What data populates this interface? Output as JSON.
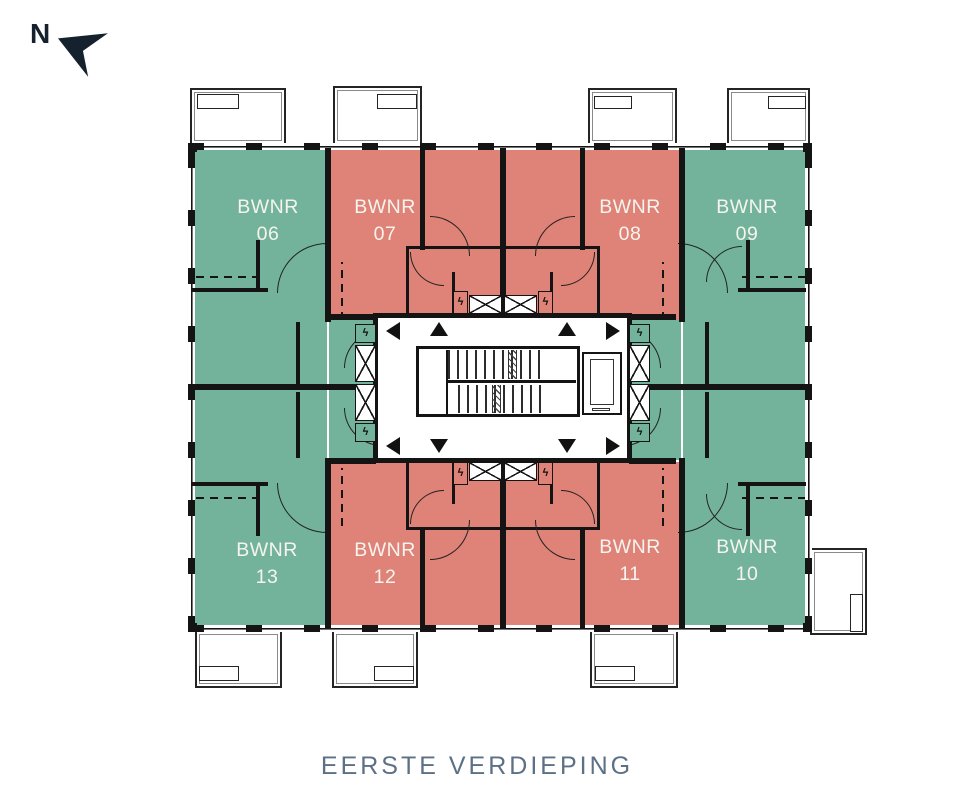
{
  "title": "EERSTE VERDIEPING",
  "compass": {
    "label": "N",
    "arrow_icon": "northwest-needle"
  },
  "units": [
    {
      "name": "BWNR",
      "number": "06",
      "color": "#73b39b",
      "position": "top-left"
    },
    {
      "name": "BWNR",
      "number": "07",
      "color": "#df8277",
      "position": "top-center-left"
    },
    {
      "name": "BWNR",
      "number": "08",
      "color": "#df8277",
      "position": "top-center-right"
    },
    {
      "name": "BWNR",
      "number": "09",
      "color": "#73b39b",
      "position": "top-right"
    },
    {
      "name": "BWNR",
      "number": "10",
      "color": "#73b39b",
      "position": "bottom-right"
    },
    {
      "name": "BWNR",
      "number": "11",
      "color": "#df8277",
      "position": "bottom-center-right"
    },
    {
      "name": "BWNR",
      "number": "12",
      "color": "#df8277",
      "position": "bottom-center-left"
    },
    {
      "name": "BWNR",
      "number": "13",
      "color": "#73b39b",
      "position": "bottom-left"
    }
  ],
  "icons": {
    "electrical": "ϟ",
    "shaft": "shaft-x-icon",
    "entrance": "direction-triangle-icon"
  },
  "palette": {
    "green": "#73b39b",
    "salmon": "#df8277",
    "wall": "#141414",
    "title_color": "#5c7086"
  }
}
